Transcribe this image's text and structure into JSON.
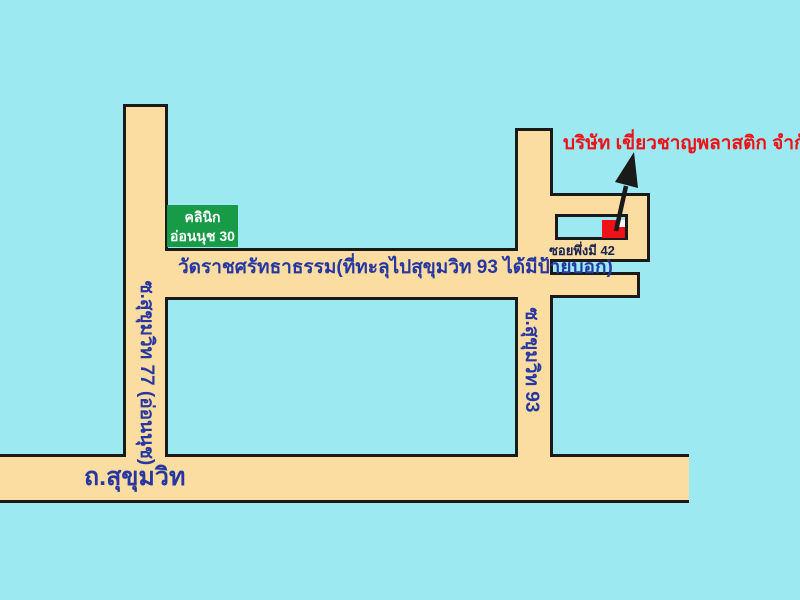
{
  "map": {
    "colors": {
      "background": "#9DE9F2",
      "road_fill": "#FCDDA1",
      "road_border": "#1A1A1A",
      "road_text_blue": "#2737A2",
      "soi_label_text": "#1A2350",
      "clinic_sign_bg": "#189B46",
      "clinic_sign_text": "#FFFFFF",
      "company_red": "#EE1118",
      "arrow_black": "#1A1A1A"
    },
    "roads": {
      "sukhumvit_road": {
        "label": "ถ.สุขุมวิท"
      },
      "soi_onnut": {
        "label": "ซ.สุขุมวิท 77 (อ่อนนุช)"
      },
      "soi_sukhumvit_93": {
        "label": "ซ.สุขุมวิท 93"
      },
      "wat_road": {
        "label": "วัดราชศรัทธาธรรม(ที่ทะลุไปสุขุมวิท 93 ได้มีป้ายบอก)"
      },
      "soi_phuengmi_42": {
        "label": "ซอยพึ่งมี 42"
      }
    },
    "landmarks": {
      "clinic_sign": {
        "line1": "คลินิก",
        "line2": "อ่อนนุช 30"
      },
      "company": {
        "name": "บริษัท เขี่ยวชาญพลาสติก จำกัด"
      }
    }
  }
}
